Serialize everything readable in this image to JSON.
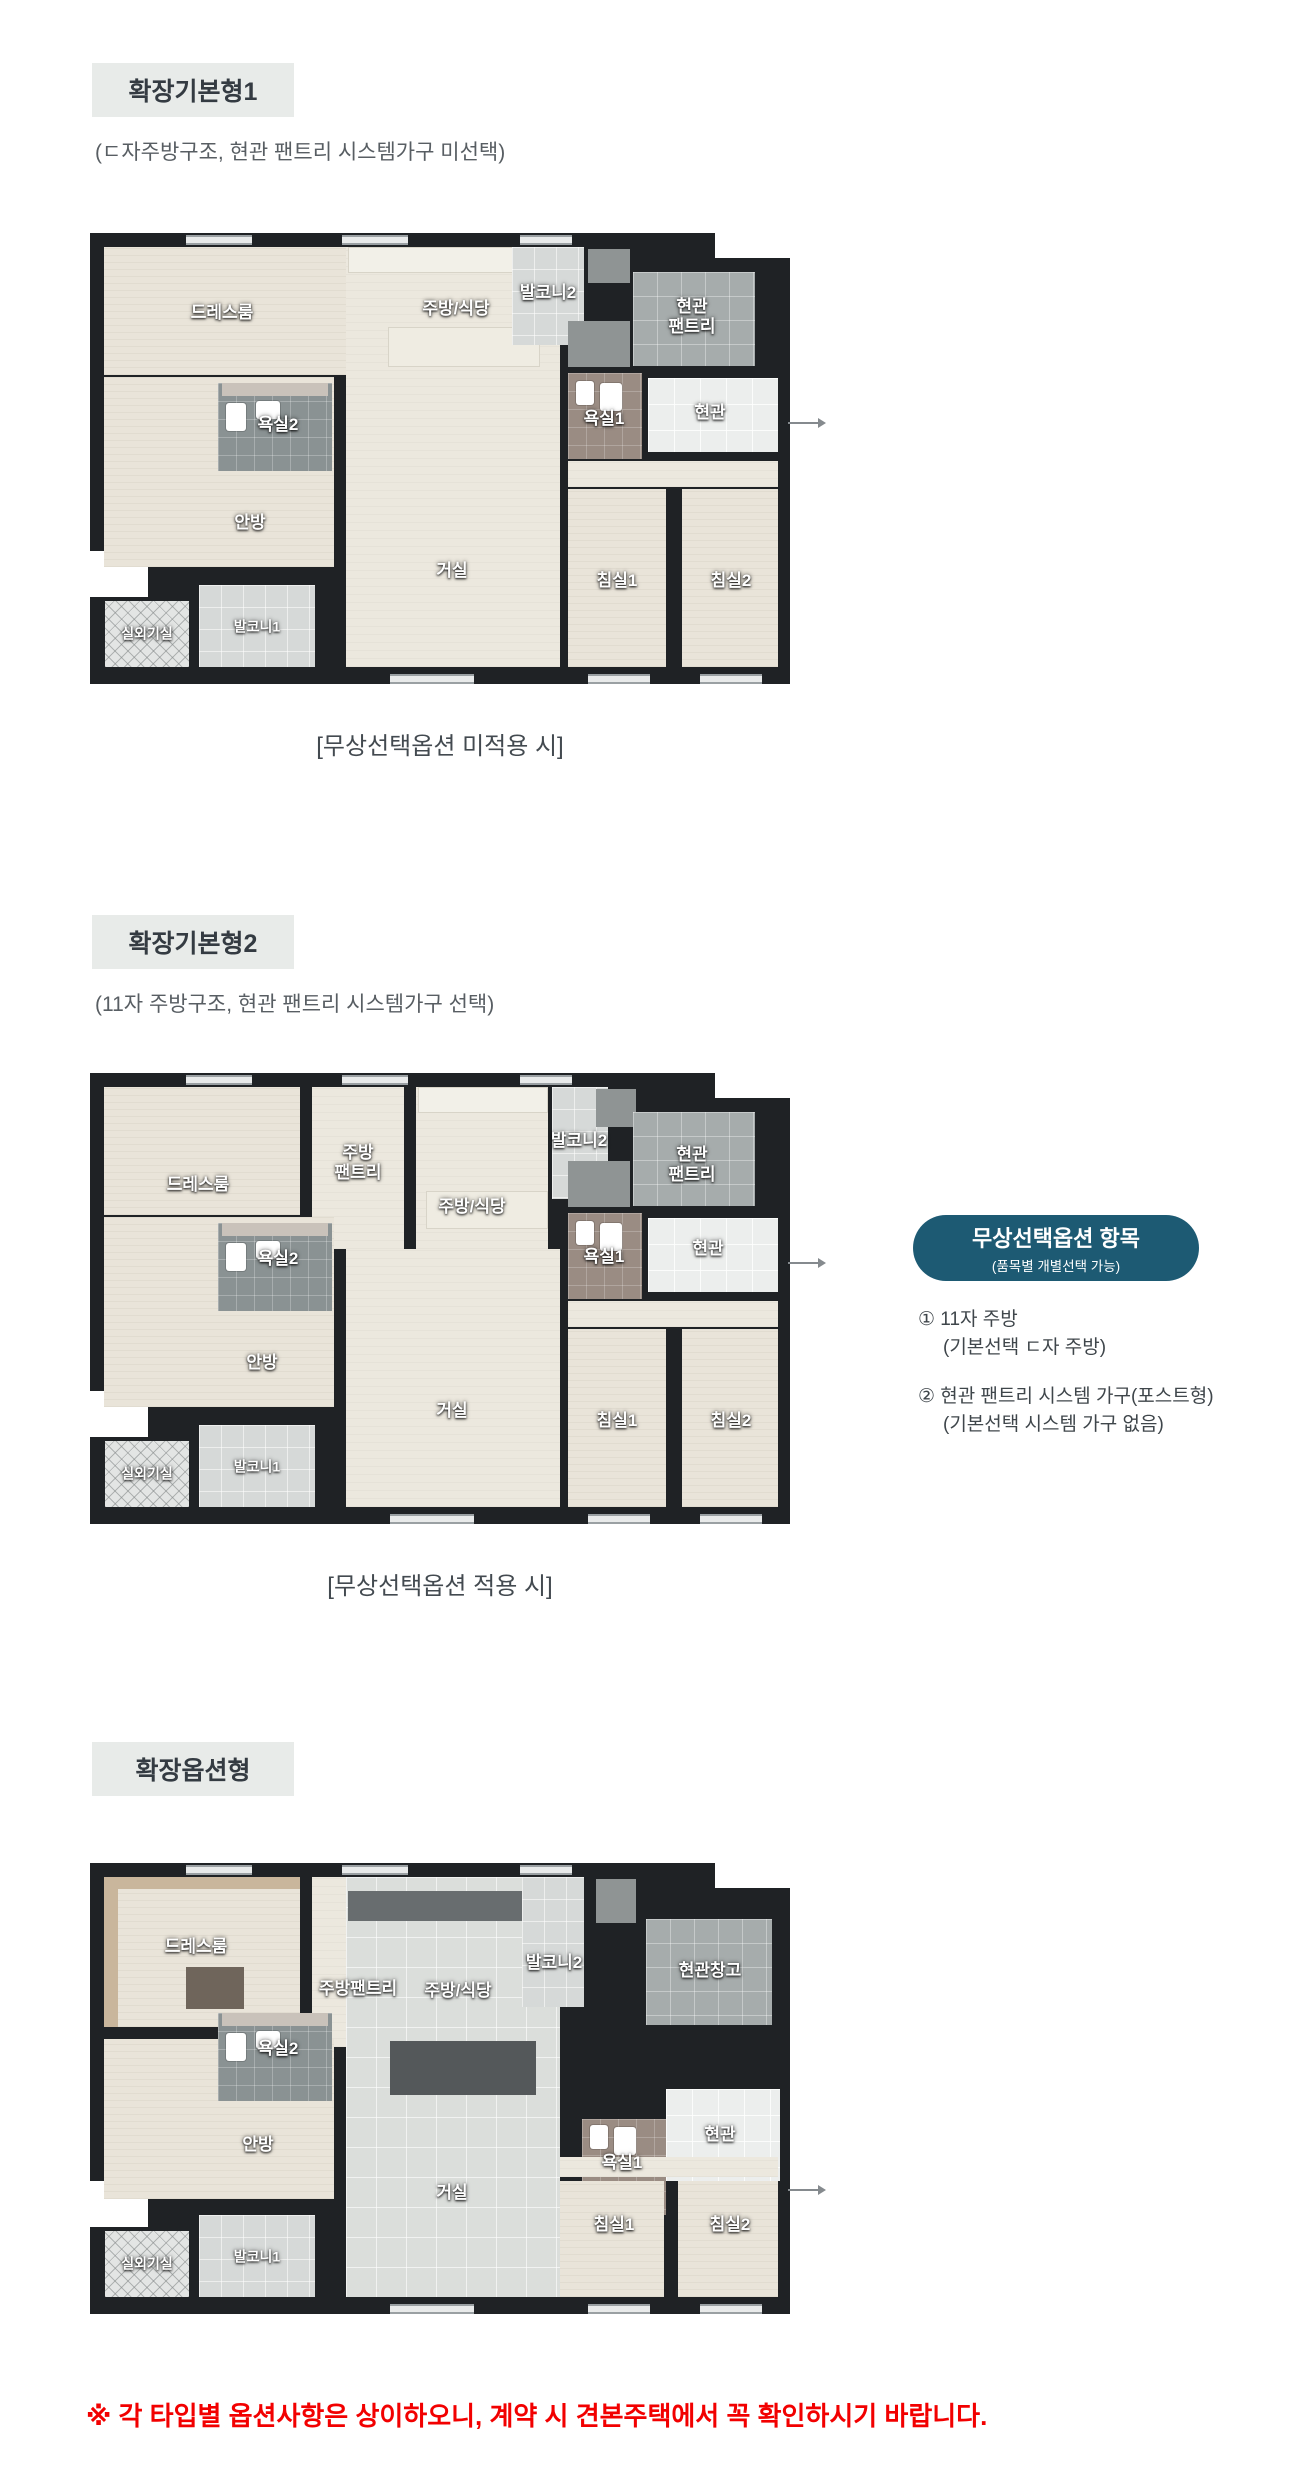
{
  "sections": [
    {
      "title": "확장기본형1",
      "subtitle": "(ㄷ자주방구조, 현관 팬트리 시스템가구 미선택)",
      "caption": "[무상선택옵션 미적용 시]"
    },
    {
      "title": "확장기본형2",
      "subtitle": "(11자 주방구조, 현관 팬트리 시스템가구 선택)",
      "caption": "[무상선택옵션 적용 시]"
    },
    {
      "title": "확장옵션형"
    }
  ],
  "plans": [
    {
      "rooms": {
        "dressroom": "드레스룸",
        "kitchen_dining": "주방/식당",
        "balcony2": "발코니2",
        "entrance_pantry": "현관\n팬트리",
        "entrance": "현관",
        "bath1": "욕실1",
        "bath2": "욕실2",
        "master_bedroom": "안방",
        "living_room": "거실",
        "bedroom1": "침실1",
        "bedroom2": "침실2",
        "balcony1": "발코니1",
        "outdoor_unit_room": "실외기실"
      }
    },
    {
      "rooms": {
        "dressroom": "드레스룸",
        "kitchen_pantry": "주방\n팬트리",
        "kitchen_dining": "주방/식당",
        "balcony2": "발코니2",
        "entrance_pantry": "현관\n팬트리",
        "entrance": "현관",
        "bath1": "욕실1",
        "bath2": "욕실2",
        "master_bedroom": "안방",
        "living_room": "거실",
        "bedroom1": "침실1",
        "bedroom2": "침실2",
        "balcony1": "발코니1",
        "outdoor_unit_room": "실외기실"
      }
    },
    {
      "rooms": {
        "dressroom": "드레스룸",
        "kitchen_pantry": "주방팬트리",
        "kitchen_dining": "주방/식당",
        "balcony2": "발코니2",
        "entrance_storage": "현관창고",
        "entrance": "현관",
        "bath1": "욕실1",
        "bath2": "욕실2",
        "master_bedroom": "안방",
        "living_room": "거실",
        "bedroom1": "침실1",
        "bedroom2": "침실2",
        "balcony1": "발코니1",
        "outdoor_unit_room": "실외기실"
      }
    }
  ],
  "option_badge": {
    "title": "무상선택옵션 항목",
    "subtitle": "(품목별 개별선택 가능)",
    "bg_color": "#1d5a73"
  },
  "option_notes": [
    {
      "item": "① 11자 주방",
      "detail": "(기본선택 ㄷ자 주방)"
    },
    {
      "item": "② 현관 팬트리 시스템 가구(포스트형)",
      "detail": "(기본선택 시스템 가구 없음)"
    }
  ],
  "footnote": "※ 각 타입별 옵션사항은 상이하오니, 계약 시 견본주택에서 꼭 확인하시기 바랍니다."
}
